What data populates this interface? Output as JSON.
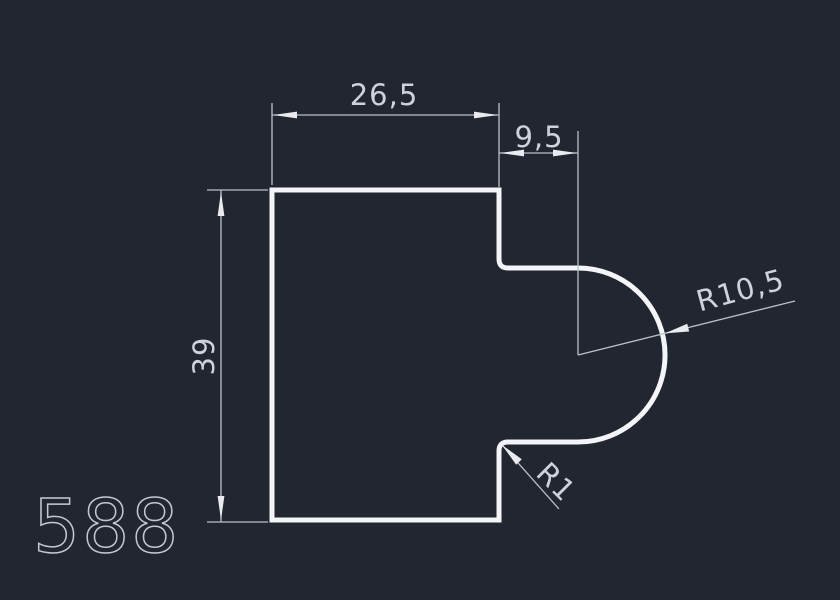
{
  "app": {
    "type": "cad-technical-drawing",
    "view": "2d-profile-section"
  },
  "colors": {
    "background": "#212630",
    "outline": "#f3f5f8",
    "dimension": "#b9c0ca",
    "arrow": "#e9ebef",
    "text": "#ced3db",
    "part_number": "#c3c9d3"
  },
  "drawing": {
    "part_number": "588",
    "dimensions": {
      "top_width": {
        "label": "26,5",
        "value": 26.5,
        "kind": "linear-horizontal"
      },
      "step_width": {
        "label": "9,5",
        "value": 9.5,
        "kind": "linear-horizontal"
      },
      "height": {
        "label": "39",
        "value": 39,
        "kind": "linear-vertical"
      },
      "large_radius": {
        "label": "R10,5",
        "value": 10.5,
        "kind": "radius"
      },
      "small_radius": {
        "label": "R1",
        "value": 1,
        "kind": "radius"
      }
    }
  }
}
